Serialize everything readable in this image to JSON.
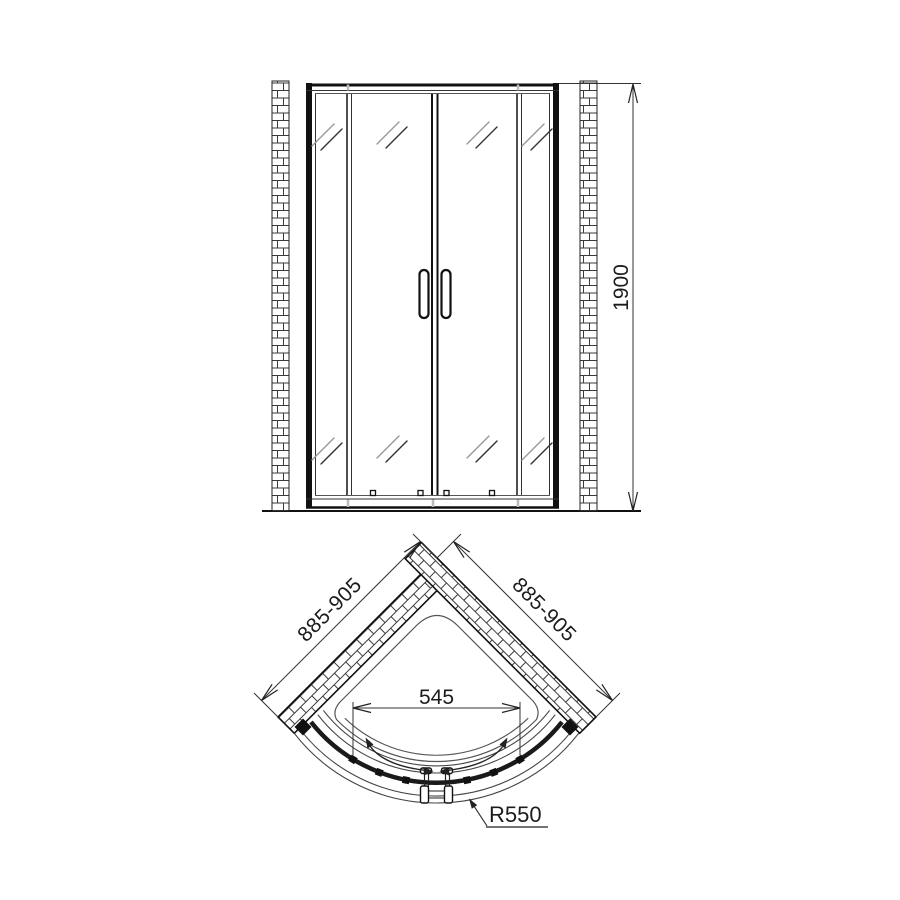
{
  "front_view": {
    "height_dim": "1900"
  },
  "plan_view": {
    "left_wall_dim": "885-905",
    "right_wall_dim": "885-905",
    "opening_width_dim": "545",
    "radius_dim": "R550"
  },
  "colors": {
    "line": "#1a1a1a",
    "thin_line": "#444444",
    "glass_mark": "#999999",
    "background": "#ffffff"
  }
}
